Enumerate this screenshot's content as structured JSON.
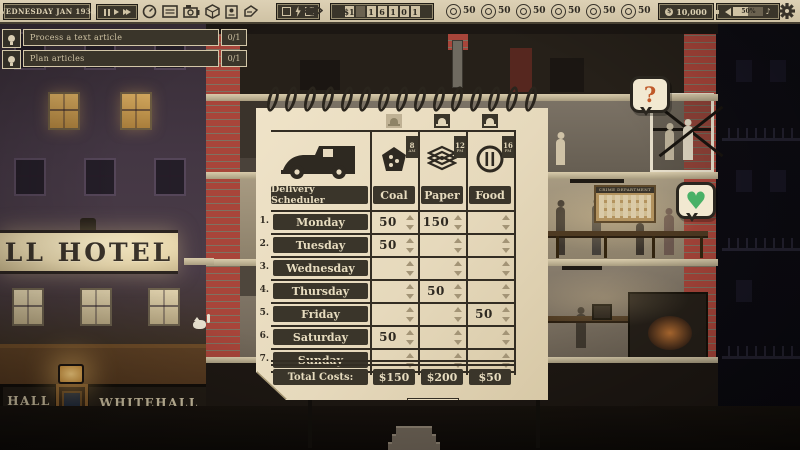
{
  "top_bar": {
    "date": "WEDNESDAY JAN 1938",
    "time_controls": {
      "pause": "pause",
      "play": "play",
      "fast_forward": "fast-forward"
    },
    "toolbar_icons": [
      "gauge",
      "document",
      "camera",
      "package",
      "id-card",
      "press"
    ],
    "counter": {
      "prefix": "$1",
      "digits": [
        "1",
        "6",
        "1",
        "0",
        "1"
      ]
    },
    "stats": [
      {
        "icon": "emblem-1",
        "value": "50"
      },
      {
        "icon": "emblem-2",
        "value": "50"
      },
      {
        "icon": "emblem-3",
        "value": "50"
      },
      {
        "icon": "emblem-4",
        "value": "50"
      },
      {
        "icon": "emblem-5",
        "value": "50"
      },
      {
        "icon": "emblem-6",
        "value": "50"
      }
    ],
    "money": "10,000",
    "volume_percent": "50%",
    "music_note": "♪"
  },
  "tasks": [
    {
      "label": "Process a text article",
      "progress": "0/1"
    },
    {
      "label": "Plan articles",
      "progress": "0/1"
    }
  ],
  "scheduler": {
    "title": "Delivery Scheduler",
    "close_label": "CLOSE",
    "columns": [
      {
        "label": "Coal",
        "delivery_hour": "8",
        "delivery_ampm": "AM",
        "alarm_on": false
      },
      {
        "label": "Paper",
        "delivery_hour": "12",
        "delivery_ampm": "PM",
        "alarm_on": true
      },
      {
        "label": "Food",
        "delivery_hour": "16",
        "delivery_ampm": "PM",
        "alarm_on": true
      }
    ],
    "rows": [
      {
        "num": "1.",
        "day": "Monday",
        "coal": "50",
        "paper": "150",
        "food": ""
      },
      {
        "num": "2.",
        "day": "Tuesday",
        "coal": "50",
        "paper": "",
        "food": ""
      },
      {
        "num": "3.",
        "day": "Wednesday",
        "coal": "",
        "paper": "",
        "food": ""
      },
      {
        "num": "4.",
        "day": "Thursday",
        "coal": "",
        "paper": "50",
        "food": ""
      },
      {
        "num": "5.",
        "day": "Friday",
        "coal": "",
        "paper": "",
        "food": "50"
      },
      {
        "num": "6.",
        "day": "Saturday",
        "coal": "50",
        "paper": "",
        "food": ""
      },
      {
        "num": "7.",
        "day": "Sunday",
        "coal": "",
        "paper": "",
        "food": ""
      }
    ],
    "totals": {
      "label": "Total Costs:",
      "coal": "$150",
      "paper": "$200",
      "food": "$50"
    }
  },
  "scene": {
    "hotel_sign": "LL HOTEL",
    "cafe_sign_left_line1": "HALL",
    "cafe_sign_left_line2": "CAFÉ",
    "cafe_sign_name": "WHITEHALL",
    "cafe_sign_subtitle": "GRAND · CAFÉ",
    "crime_board_title": "CRIME DEPARTMENT",
    "question_bubble": "?",
    "heart_bubble": "♥"
  },
  "colors": {
    "brick_red": "#a8453a",
    "paper_cream": "#e7dabf",
    "ink": "#332d23",
    "heart_green": "#49b167",
    "question_orange": "#c05a2a",
    "topbar_tan": "#d8ccb0"
  }
}
